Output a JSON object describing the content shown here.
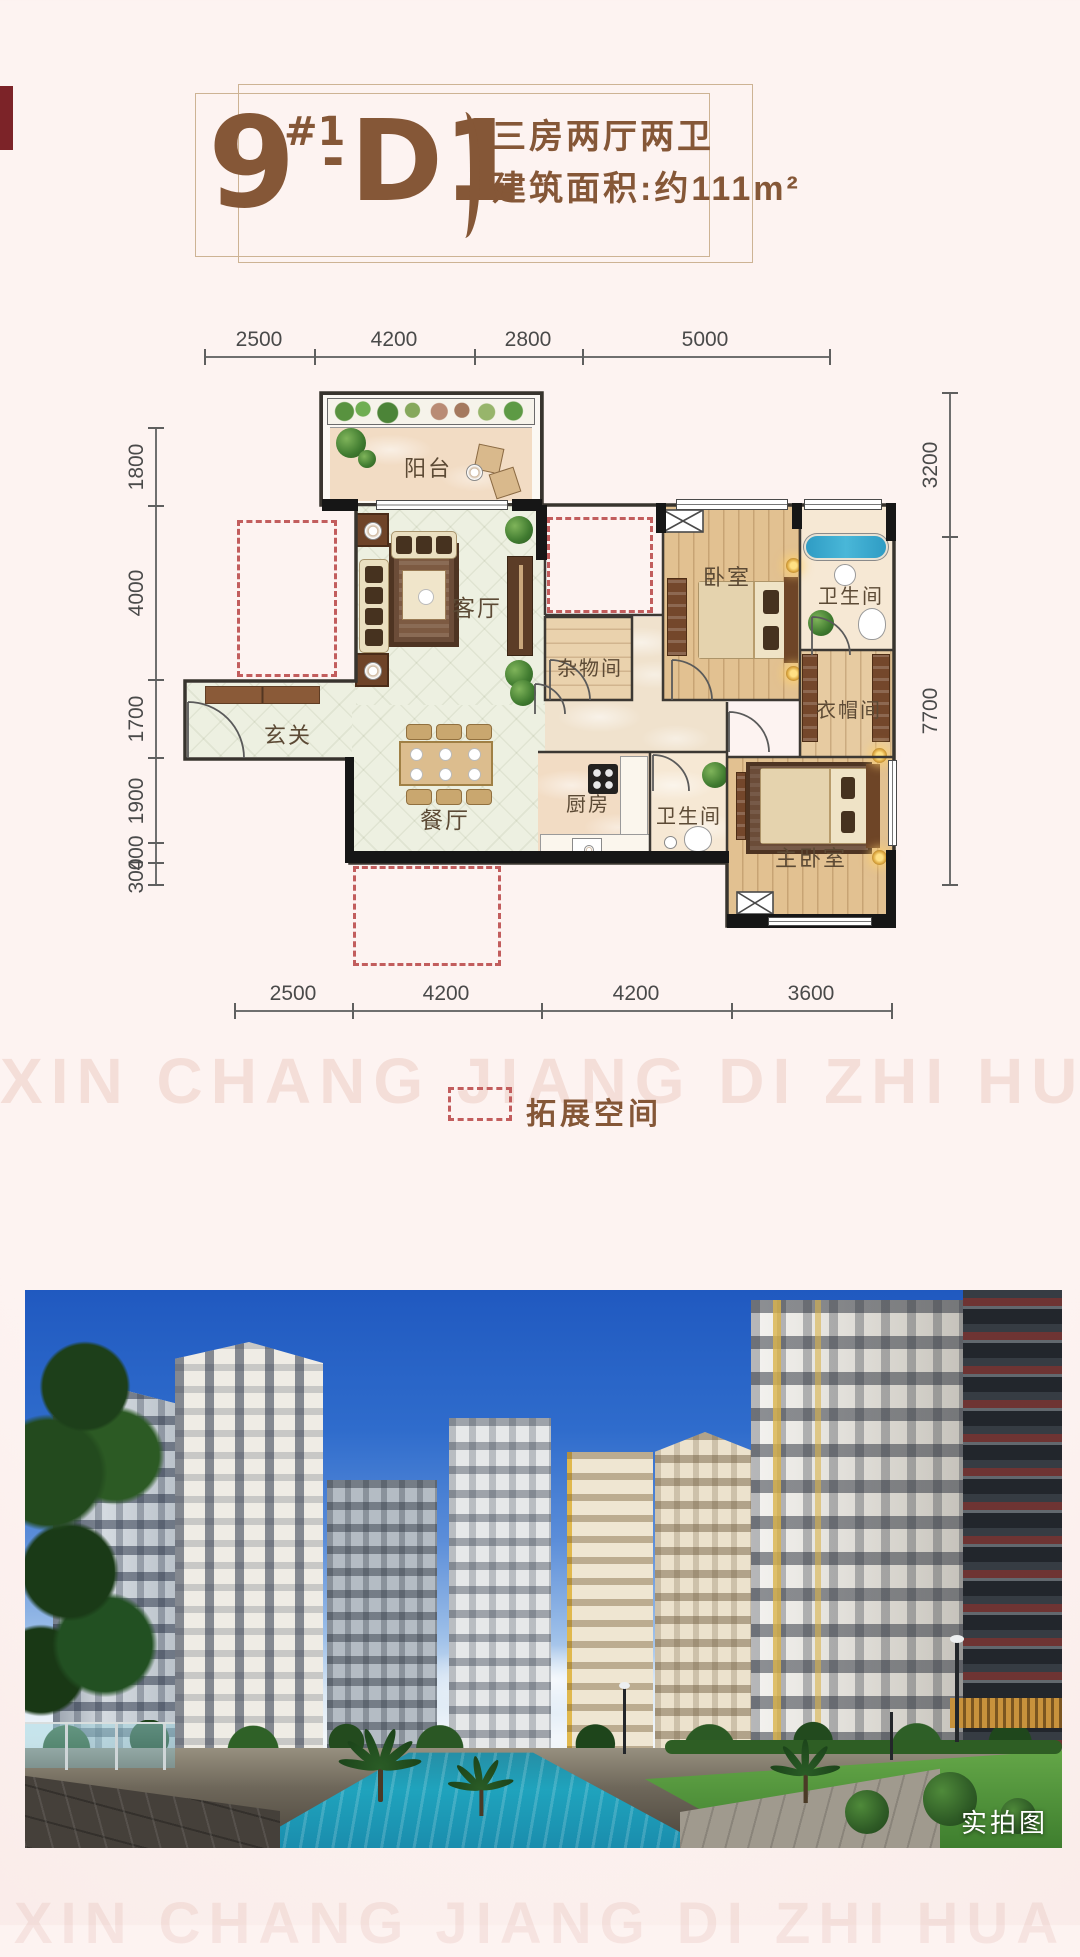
{
  "theme": {
    "accent": "#855737",
    "dash_red": "#c25d5d",
    "page_bg": "#fbefec",
    "dim_text": "#4a4a4a"
  },
  "header": {
    "building": "9",
    "sup": "#1",
    "dash": "-",
    "unit": "D1",
    "line1": "三房两厅两卫",
    "line2": "建筑面积:约111m²"
  },
  "dims": {
    "top": [
      "2500",
      "4200",
      "2800",
      "5000"
    ],
    "bottom": [
      "2500",
      "4200",
      "4200",
      "3600"
    ],
    "left": [
      "1800",
      "4000",
      "1700",
      "1900",
      "400",
      "300"
    ],
    "right": [
      "3200",
      "7700"
    ]
  },
  "labels": {
    "balcony": "阳台",
    "living": "客厅",
    "entry": "玄关",
    "dining": "餐厅",
    "kitchen": "厨房",
    "storage": "杂物间",
    "bedroom": "卧室",
    "bath_main": "卫生间",
    "bath_second": "卫生间",
    "cloakroom": "衣帽间",
    "master_bedroom": "主卧室"
  },
  "legend": {
    "label": "拓展空间"
  },
  "watermark": {
    "text": "XIN CHANG JIANG DI ZHI HUA"
  },
  "photo": {
    "tag": "实拍图"
  }
}
